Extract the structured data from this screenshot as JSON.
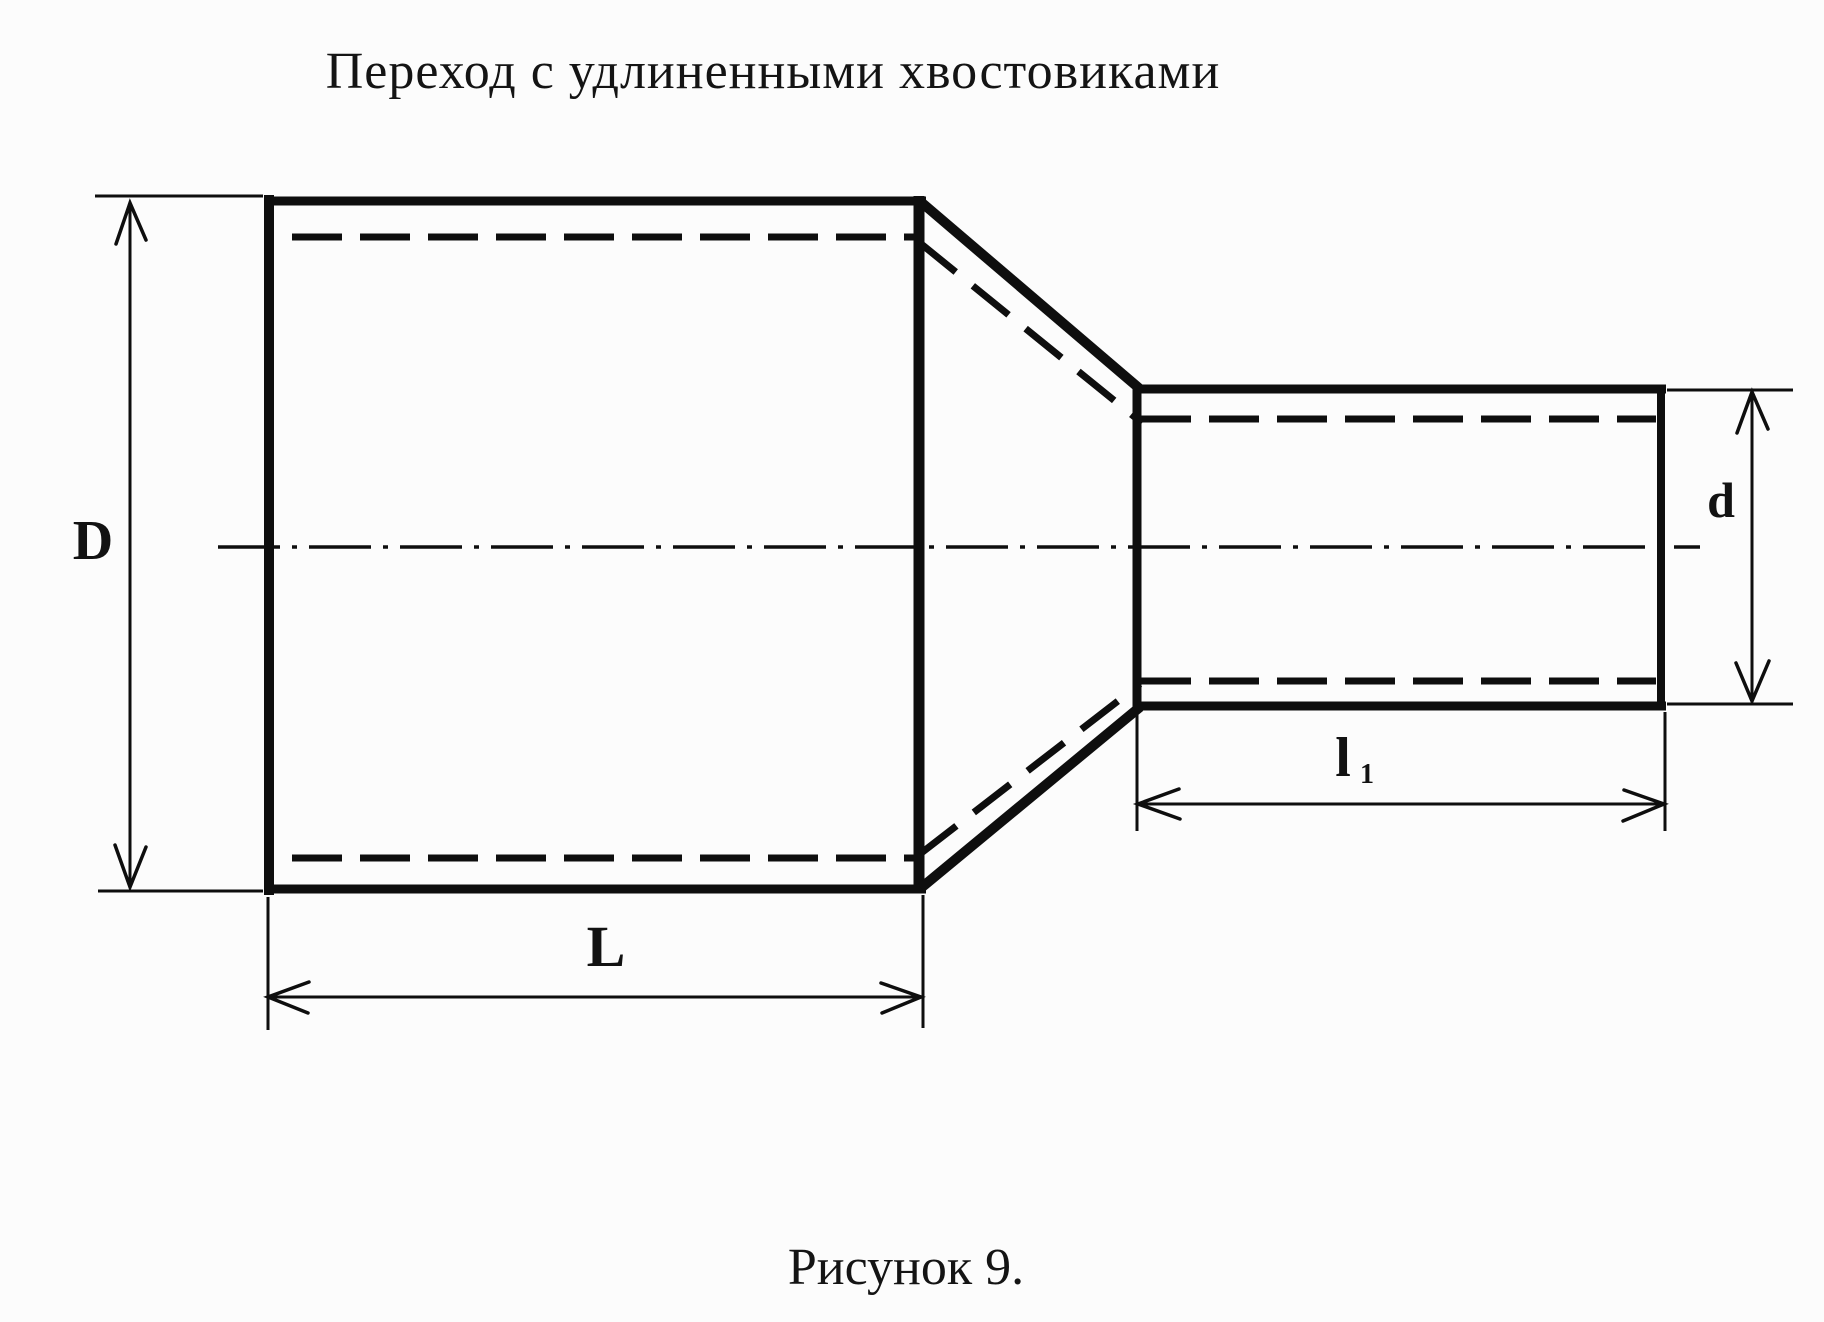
{
  "title": "Переход с удлиненными хвостовиками",
  "caption": "Рисунок 9.",
  "dimension_labels": {
    "large_diameter": "D",
    "large_length": "L",
    "small_diameter": "d",
    "small_length_base": "l",
    "small_length_subscript": "1"
  },
  "colors": {
    "background": "#fcfcfc",
    "line": "#0e0e0e",
    "text": "#141414"
  }
}
